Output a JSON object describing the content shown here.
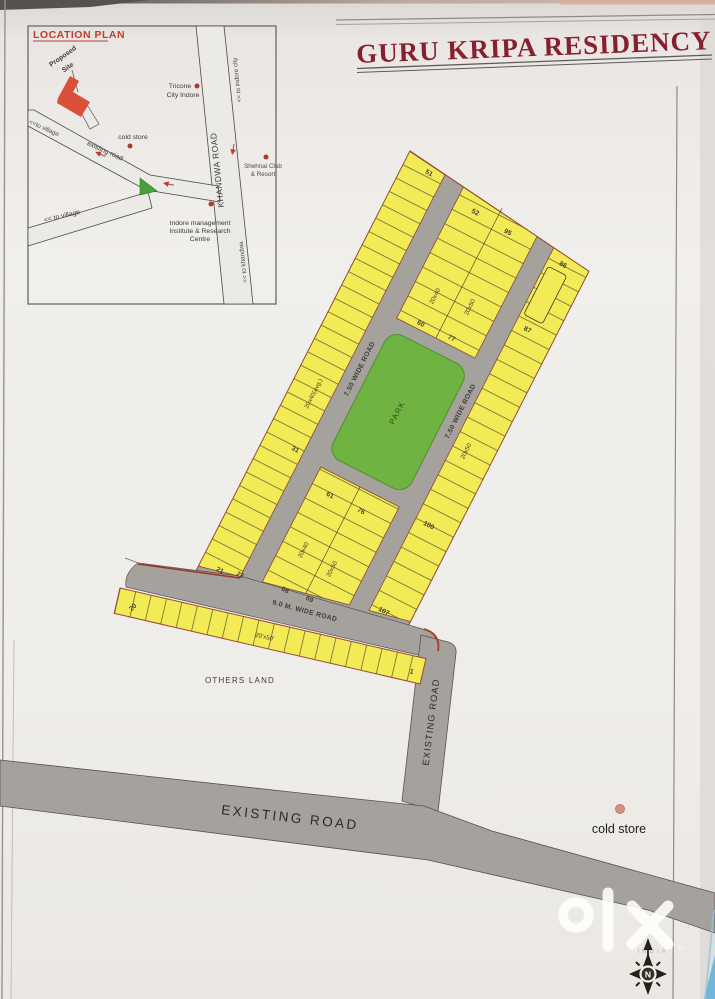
{
  "page": {
    "title": "GURU KRIPA RESIDENCY"
  },
  "location_plan": {
    "heading": "LOCATION PLAN",
    "proposed_site": {
      "line1": "Proposed",
      "line2": "Site"
    },
    "roads": {
      "khandwa": "KHANDWA ROAD",
      "existing": "existing road"
    },
    "directions": {
      "to_indore_city": "<< to indore city",
      "to_khandwa": "<< to khandwa",
      "to_village_upper": "<<to village",
      "to_village_lower": "<< to village"
    },
    "places": {
      "tricone1": "Tricone",
      "tricone2": "City Indore",
      "cold_store": "cold store",
      "shehnai1": "Shehnai Club",
      "shehnai2": "& Resort",
      "institute1": "Indore management",
      "institute2": "Institute & Research",
      "institute3": "Centre"
    }
  },
  "site_plan": {
    "park": "PARK",
    "wide_road_750": "7.50 WIDE ROAD",
    "wide_road_9m": "9.0 M. WIDE ROAD",
    "others_land": "OTHERS LAND",
    "dims": {
      "d2040avg": "20x40(avg.)",
      "d2040": "20x40",
      "d2050": "20x50",
      "d2050b": "20'x50'"
    },
    "plots": {
      "p1": "1",
      "p20": "20",
      "p21": "21",
      "p22": "22",
      "p31": "31",
      "p51": "51",
      "p52": "52",
      "p60": "60",
      "p61": "61",
      "p68": "68",
      "p69": "69",
      "p76": "76",
      "p77": "77",
      "p86": "86",
      "p87": "87",
      "p95": "95",
      "p100": "100",
      "p107": "107"
    }
  },
  "roads": {
    "existing_vertical": "EXISTING ROAD",
    "existing_horizontal": "EXISTING ROAD"
  },
  "landmarks": {
    "cold_store": "cold store"
  },
  "watermark": {
    "brand": "olx",
    "country": "INDIA"
  },
  "compass": {
    "north": "N"
  },
  "colors": {
    "plot_yellow": "#f3eb56",
    "park_green": "#6fb342",
    "road_gray": "#a5a19d",
    "boundary": "#9c4734",
    "title": "#86202e",
    "accent_red": "#c23b2e",
    "paper": "#efedeb"
  }
}
